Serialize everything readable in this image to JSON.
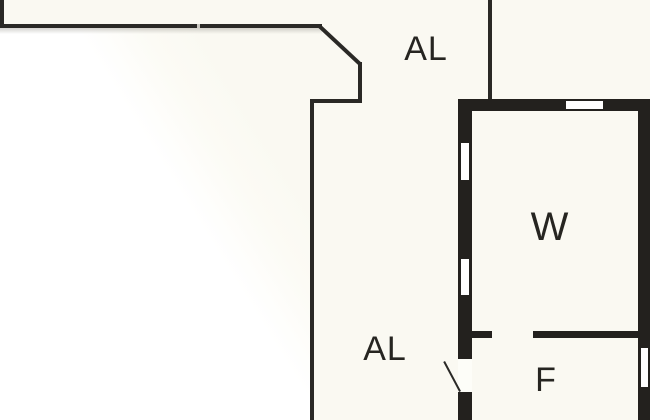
{
  "plan": {
    "type": "floor-plan",
    "rooms": {
      "hall_upper": {
        "label": "AL"
      },
      "hall_lower": {
        "label": "AL"
      },
      "room_w": {
        "label": "W"
      },
      "room_f": {
        "label": "F"
      }
    },
    "features": [
      "thin-walled hall (AL) running from top-left down the center",
      "45-degree diagonal wall at top-left building corner",
      "thick-walled room block at right with rooms W (upper) and F (lower)",
      "three windows: left wall upper, left wall lower, top wall; one window in right wall",
      "door opening with swing line at lower-left of room F",
      "interior partition wall with door gap between W and F"
    ]
  },
  "colors": {
    "background": "#FAF9F2",
    "exterior": "#FFFFFF",
    "wall": "#23211E",
    "thin_line": "#2A2926",
    "window_fill": "#FFFFFF",
    "text": "#262521"
  }
}
